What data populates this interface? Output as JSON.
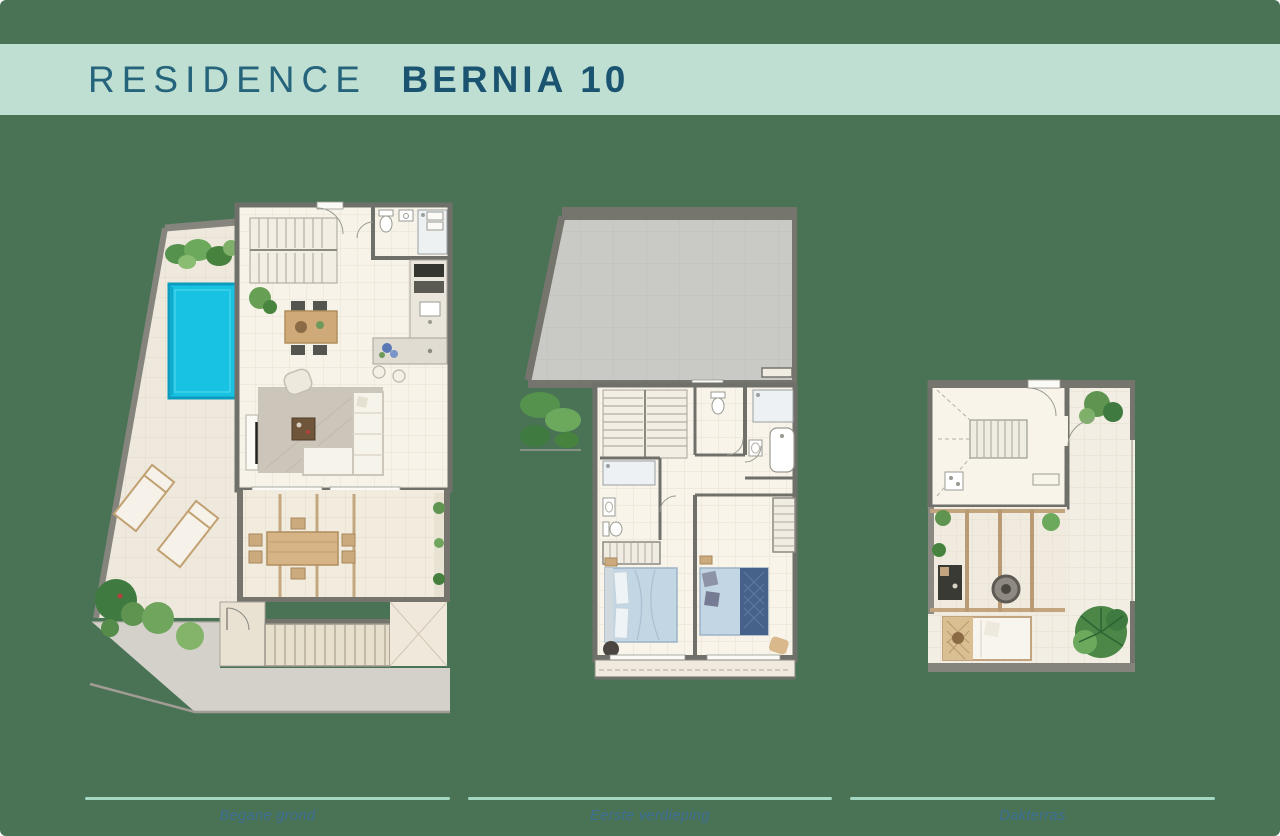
{
  "page": {
    "title_light": "RESIDENCE",
    "title_bold": "BERNIA 10"
  },
  "plans": [
    {
      "id": "ground-floor",
      "label": "Begane grond"
    },
    {
      "id": "first-floor",
      "label": "Eerste verdieping"
    },
    {
      "id": "roof-terrace",
      "label": "Dakterras"
    }
  ],
  "colors": {
    "background_green": "#4a7356",
    "header_band_mint": "#bedfd1",
    "title_text": "#26647c",
    "title_bold_text": "#1a5470",
    "divider_mint": "#a5d8c2",
    "caption_text": "#3e6f95",
    "pool_water": "#18c2e2",
    "floor_cream": "#f7f3e9",
    "terrace_cream": "#eee8dd",
    "wall_gray": "#70706a",
    "roof_gray": "#c9c9c5",
    "driveway_gray": "#d4d1ca",
    "plant_green": "#5e9450",
    "wood_tan": "#d6b486",
    "bed_blue": "#c3d6e4",
    "blanket_navy": "#46628a"
  }
}
